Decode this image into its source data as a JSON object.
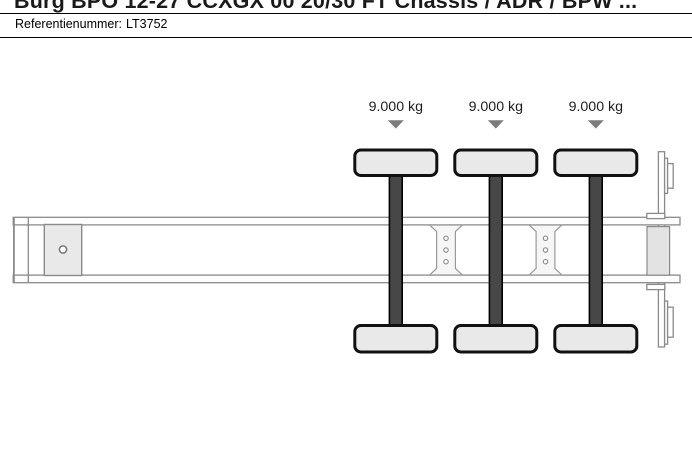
{
  "header": {
    "title": "Burg BPO 12-27 CCXGX 00 20/30 FT Chassis / ADR / BPW ...",
    "reference_label": "Referentienummer:",
    "reference_value": "LT3752"
  },
  "diagram": {
    "description": "Top-view schematic of a 3-axle container chassis trailer",
    "axles": [
      {
        "name": "axle-1",
        "load": "9.000 kg"
      },
      {
        "name": "axle-2",
        "load": "9.000 kg"
      },
      {
        "name": "axle-3",
        "load": "9.000 kg"
      }
    ],
    "colors": {
      "wheel_fill": "#e9e9e9",
      "axle_fill": "#474747",
      "arrow_fill": "#7c7c7c",
      "kingpin_block_fill": "#e9e9e9",
      "frame_stroke": "#8a8a8a"
    }
  }
}
